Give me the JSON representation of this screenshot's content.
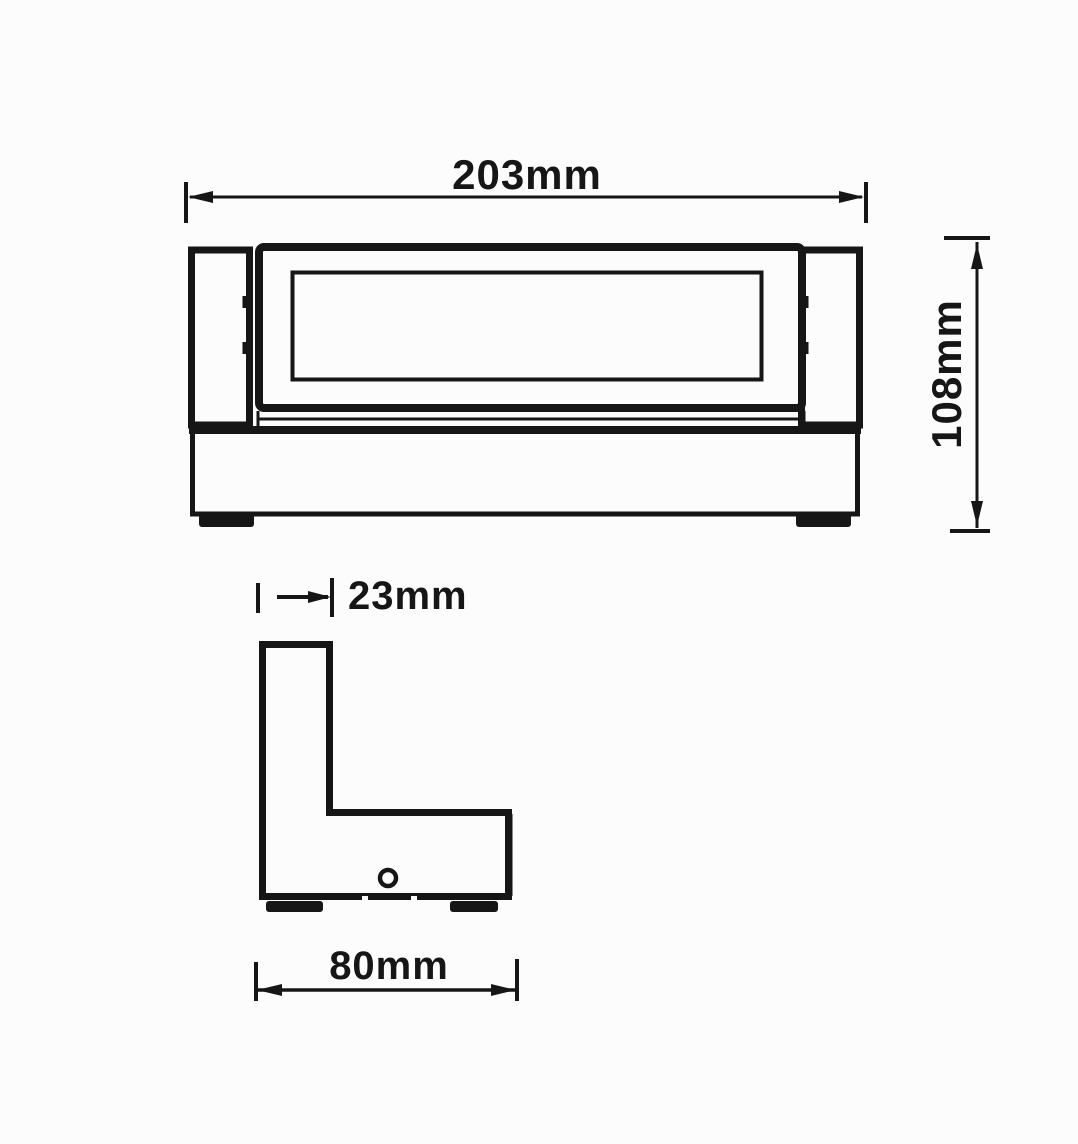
{
  "drawing": {
    "kind": "dimension-drawing",
    "views": {
      "front": {
        "dimension_count": "2"
      },
      "side": {
        "dimension_count": "2"
      }
    }
  },
  "dimensions": {
    "front_width": {
      "label": "203mm"
    },
    "front_height": {
      "label": "108mm"
    },
    "side_top_depth": {
      "label": "23mm"
    },
    "side_overall_depth": {
      "label": "80mm"
    }
  },
  "colors": {
    "line": "#161616",
    "background": "#fcfcfc"
  }
}
